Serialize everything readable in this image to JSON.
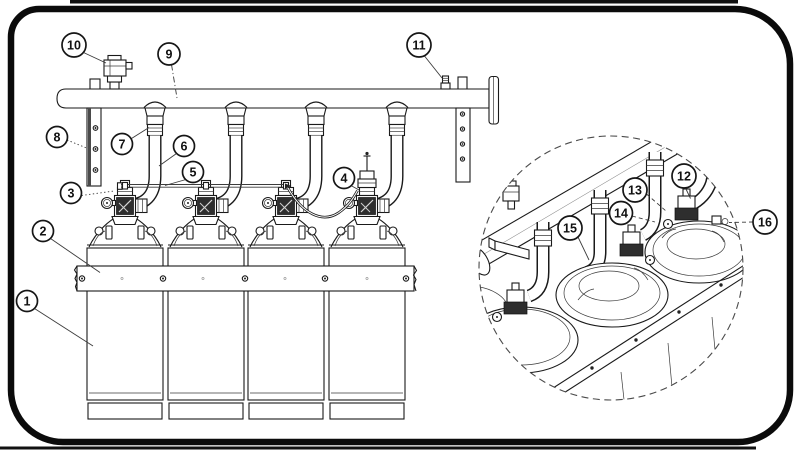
{
  "colors": {
    "ink": "#1a1a1a",
    "background": "#ffffff"
  },
  "callouts": [
    {
      "number": "1"
    },
    {
      "number": "2"
    },
    {
      "number": "3"
    },
    {
      "number": "4"
    },
    {
      "number": "5"
    },
    {
      "number": "6"
    },
    {
      "number": "7"
    },
    {
      "number": "8"
    },
    {
      "number": "9"
    },
    {
      "number": "10"
    },
    {
      "number": "11"
    },
    {
      "number": "12"
    },
    {
      "number": "13"
    },
    {
      "number": "14"
    },
    {
      "number": "15"
    },
    {
      "number": "16"
    }
  ]
}
